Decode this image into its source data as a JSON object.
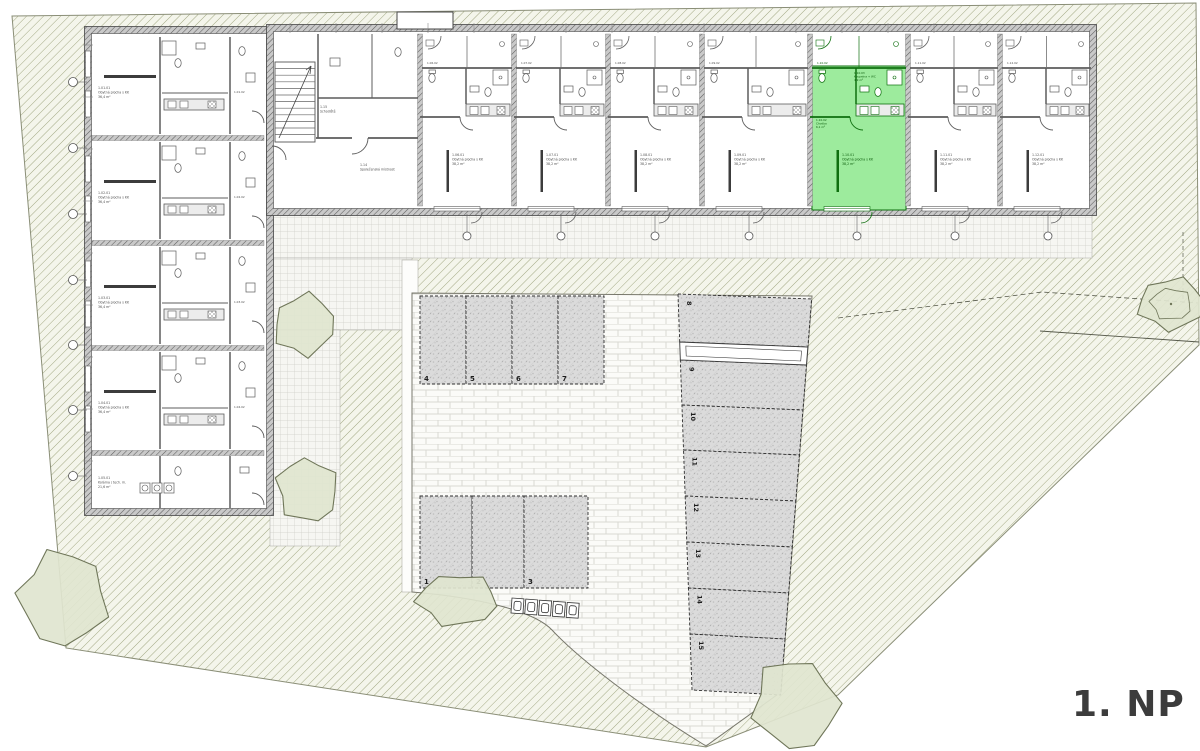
{
  "floor_label": "1. NP",
  "colors": {
    "highlight": "#9DEB9D",
    "highlight_line": "#0E6F0E",
    "highlight_text": "#0A5A0A",
    "wall": "#474747",
    "line": "#5C5C5C",
    "label_text": "#4E4E4E",
    "floor_label_color": "#3C3C3C",
    "hatch_line": "#A2A883",
    "hatch_bg": "#F4F5EB",
    "tile_line": "#CFCFC8",
    "paving_line": "#D8D8D2",
    "paving_bg": "#FBFBF8",
    "parking_fill": "#DBDBDB",
    "parking_dot": "#BDBDBD",
    "bush_fill": "#E0E5CF",
    "bush_stroke": "#6F7659"
  },
  "parking": {
    "top_row": [
      "4",
      "5",
      "6",
      "7"
    ],
    "bottom_row": [
      "1",
      "2",
      "3"
    ],
    "right_column": [
      "8",
      "9",
      "10",
      "11",
      "12",
      "13",
      "14",
      "15"
    ]
  },
  "units": {
    "left_wing": [
      {
        "id": "1.01",
        "sub": "1.01.02",
        "lines": [
          "1.01.01",
          "Obytná plocha s KK",
          "36,4 m²"
        ]
      },
      {
        "id": "1.02",
        "sub": "1.02.02",
        "lines": [
          "1.02.01",
          "Obytná plocha s KK",
          "36,4 m²"
        ]
      },
      {
        "id": "1.03",
        "sub": "1.03.02",
        "lines": [
          "1.03.01",
          "Obytná plocha s KK",
          "36,4 m²"
        ]
      },
      {
        "id": "1.04",
        "sub": "1.04.02",
        "lines": [
          "1.04.01",
          "Obytná plocha s KK",
          "36,4 m²"
        ]
      },
      {
        "id": "1.05",
        "sub": "1.05.02",
        "lines": [
          "1.05.01",
          "Kolárna / tech. m.",
          "21,6 m²"
        ]
      }
    ],
    "top_wing": [
      {
        "id": "1.06",
        "sub": "1.06.02",
        "lines": [
          "1.06.01",
          "Obytná plocha s KK",
          "38,2 m²"
        ]
      },
      {
        "id": "1.07",
        "sub": "1.07.02",
        "lines": [
          "1.07.01",
          "Obytná plocha s KK",
          "38,2 m²"
        ]
      },
      {
        "id": "1.08",
        "sub": "1.08.02",
        "lines": [
          "1.08.01",
          "Obytná plocha s KK",
          "38,2 m²"
        ]
      },
      {
        "id": "1.09",
        "sub": "1.09.02",
        "lines": [
          "1.09.01",
          "Obytná plocha s KK",
          "38,2 m²"
        ]
      },
      {
        "id": "1.10",
        "sub": "1.10.02",
        "highlighted": true,
        "lines": [
          "1.10.01",
          "Obytná plocha s KK",
          "38,2 m²"
        ]
      },
      {
        "id": "1.11",
        "sub": "1.11.02",
        "lines": [
          "1.11.01",
          "Obytná plocha s KK",
          "38,2 m²"
        ]
      },
      {
        "id": "1.12",
        "sub": "1.12.02",
        "lines": [
          "1.12.01",
          "Obytná plocha s KK",
          "38,2 m²"
        ]
      }
    ],
    "core": {
      "common_room": [
        "1.14",
        "Společenská místnost"
      ],
      "stairs": [
        "1.15",
        "Schodiště"
      ]
    },
    "highlight_extra": {
      "hall": [
        "1.10.02",
        "Chodba",
        "6,1 m²"
      ],
      "bath": [
        "1.10.03",
        "Koupelna + WC",
        "4,9 m²"
      ]
    }
  }
}
